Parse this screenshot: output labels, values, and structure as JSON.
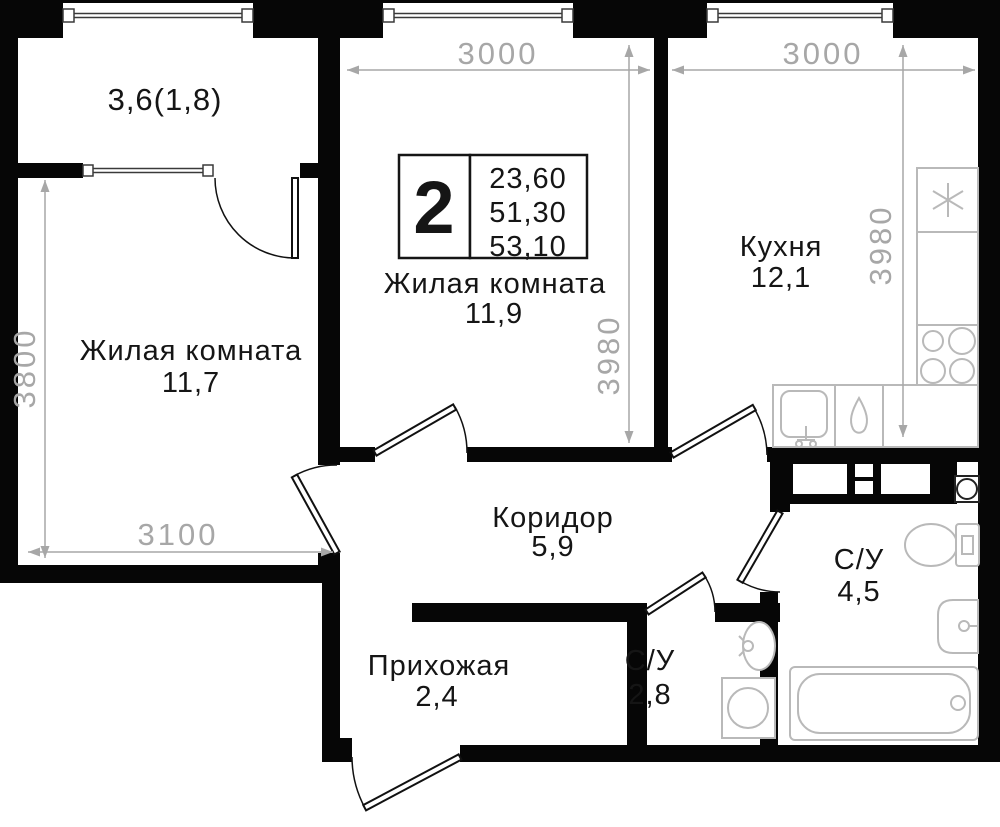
{
  "plan": {
    "title_block": {
      "rooms_count": "2",
      "area_values": [
        "23,60",
        "51,30",
        "53,10"
      ]
    },
    "rooms": {
      "balcony": {
        "label": "3,6(1,8)"
      },
      "living_left": {
        "name": "Жилая комната",
        "area": "11,7"
      },
      "living_middle": {
        "name": "Жилая комната",
        "area": "11,9"
      },
      "kitchen": {
        "name": "Кухня",
        "area": "12,1"
      },
      "corridor": {
        "name": "Коридор",
        "area": "5,9"
      },
      "hallway": {
        "name": "Прихожая",
        "area": "2,4"
      },
      "bathroom_small": {
        "name": "С/У",
        "area": "2,8"
      },
      "bathroom_big": {
        "name": "С/У",
        "area": "4,5"
      }
    },
    "dimensions": {
      "living_middle_width": "3000",
      "kitchen_width": "3000",
      "living_middle_depth": "3980",
      "kitchen_depth": "3980",
      "living_left_depth": "3800",
      "living_left_width": "3100"
    },
    "fixtures": {
      "kitchen": [
        "fridge-snowflake",
        "tall-cabinet",
        "stove-4-burners",
        "counter",
        "sink",
        "water-drop-boiler"
      ],
      "bathroom_small": [
        "washbasin",
        "washing-machine"
      ],
      "bathroom_big": [
        "extractor-fan",
        "toilet",
        "washbasin",
        "bathtub",
        "vent-shafts"
      ]
    },
    "colors": {
      "wall": "#060606",
      "fixture_stroke": "#b9b9b9",
      "dimension": "#a7a7a7",
      "text": "#151515",
      "background": "#ffffff"
    }
  }
}
